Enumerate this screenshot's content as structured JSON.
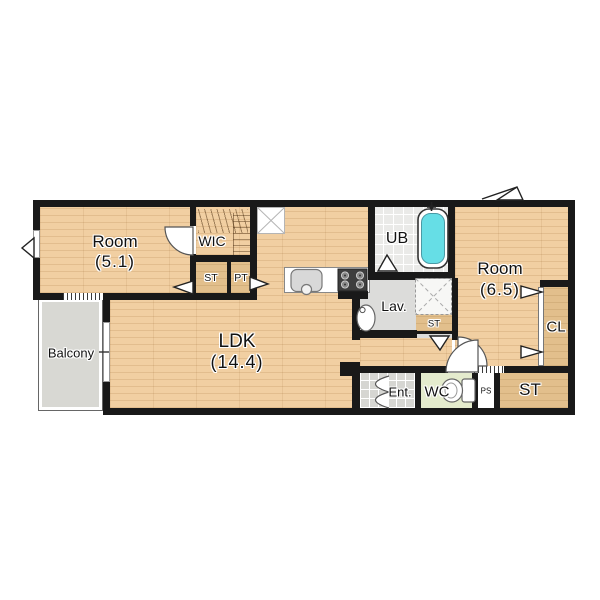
{
  "floor_plan": {
    "title": "1LDK apartment floor plan",
    "rooms": {
      "room1": {
        "name": "Room",
        "size": "(5.1)"
      },
      "wic": {
        "label": "WIC"
      },
      "st_upper": {
        "label": "ST"
      },
      "pt": {
        "label": "PT"
      },
      "ldk": {
        "name": "LDK",
        "size": "(14.4)"
      },
      "balcony": {
        "label": "Balcony"
      },
      "ub": {
        "label": "UB"
      },
      "lav": {
        "label": "Lav."
      },
      "st_lav": {
        "label": "ST"
      },
      "room2": {
        "name": "Room",
        "size": "(6.5)"
      },
      "cl": {
        "label": "CL"
      },
      "ent": {
        "label": "Ent."
      },
      "wc": {
        "label": "WC"
      },
      "ps": {
        "label": "PS"
      },
      "st_lower": {
        "label": "ST"
      }
    },
    "fixtures": [
      "bathtub",
      "toilet",
      "wash-basin",
      "kitchen-sink",
      "stove",
      "washing-machine-pan",
      "refrigerator-space",
      "clothes-rod"
    ],
    "colors": {
      "wall": "#191919",
      "wood_floor": "#f1cfa2",
      "closet": "#e2bf8c",
      "unit_bath_tile": "#eaeae8",
      "entrance_tile": "#d6d6d2",
      "wc_floor": "#e4ebcd",
      "balcony": "#d8d8d3",
      "bathtub_water": "#66dee6"
    }
  }
}
